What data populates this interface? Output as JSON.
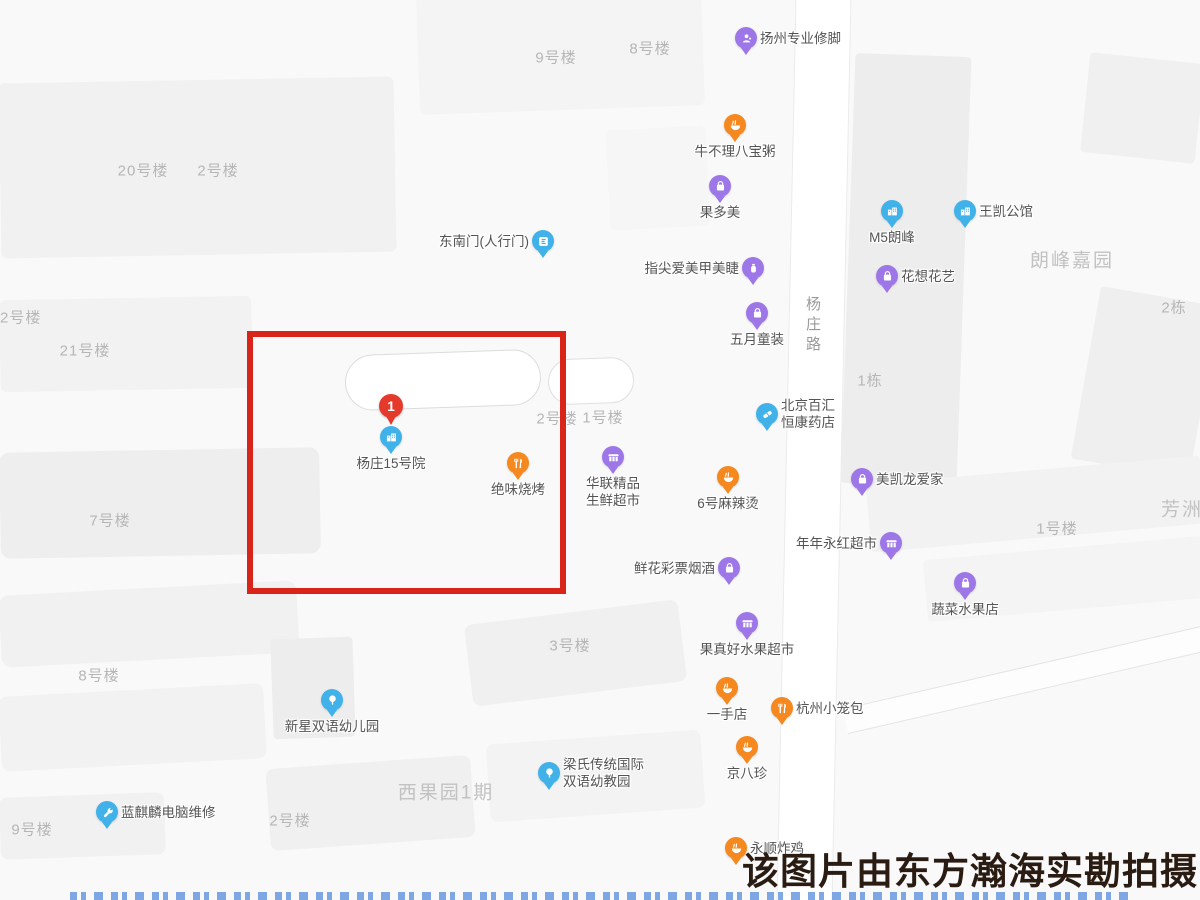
{
  "map": {
    "watermark": {
      "text": "该图片由东方瀚海实勘拍摄",
      "color": "#2a1c12"
    },
    "road_label": {
      "text": "杨庄路",
      "x": 802,
      "y": 296
    },
    "highlight_box": {
      "x": 247,
      "y": 331,
      "width": 319,
      "height": 263,
      "color": "#d9241a"
    },
    "colors": {
      "purple": "#9d77e8",
      "orange": "#f5881f",
      "blue": "#41b2e9",
      "red_pin": "#e5392c",
      "poi_text": "#545454",
      "building_text": "#b6b6b6",
      "area_text": "#c2c2c2"
    },
    "building_labels": [
      {
        "text": "9号楼",
        "x": 556,
        "y": 57
      },
      {
        "text": "8号楼",
        "x": 650,
        "y": 48
      },
      {
        "text": "20号楼",
        "x": 143,
        "y": 170
      },
      {
        "text": "2号楼",
        "x": 218,
        "y": 170
      },
      {
        "text": "22号楼",
        "x": 16,
        "y": 317
      },
      {
        "text": "21号楼",
        "x": 85,
        "y": 350
      },
      {
        "text": "2号楼",
        "x": 557,
        "y": 418
      },
      {
        "text": "1号楼",
        "x": 603,
        "y": 417
      },
      {
        "text": "7号楼",
        "x": 110,
        "y": 520
      },
      {
        "text": "1号楼",
        "x": 1057,
        "y": 528
      },
      {
        "text": "8号楼",
        "x": 99,
        "y": 675
      },
      {
        "text": "3号楼",
        "x": 570,
        "y": 645
      },
      {
        "text": "9号楼",
        "x": 32,
        "y": 829
      },
      {
        "text": "2号楼",
        "x": 290,
        "y": 820
      },
      {
        "text": "1栋",
        "x": 870,
        "y": 380
      },
      {
        "text": "2栋",
        "x": 1174,
        "y": 307
      }
    ],
    "area_labels": [
      {
        "text": "朗峰嘉园",
        "x": 1072,
        "y": 259
      },
      {
        "text": "西果园1期",
        "x": 446,
        "y": 791
      },
      {
        "text": "芳洲",
        "x": 1182,
        "y": 508
      }
    ],
    "pois": [
      {
        "id": "yangzhou-foot-massage",
        "label": "扬州专业修脚",
        "color": "purple",
        "icon": "massage",
        "x": 746,
        "y": 54,
        "pos": "right"
      },
      {
        "id": "niubuli-porridge",
        "label": "牛不理八宝粥",
        "color": "orange",
        "icon": "bowl",
        "x": 735,
        "y": 141,
        "pos": "below"
      },
      {
        "id": "guoduomei",
        "label": "果多美",
        "color": "purple",
        "icon": "bag",
        "x": 720,
        "y": 202,
        "pos": "below"
      },
      {
        "id": "southeast-gate",
        "label": "东南门(人行门)",
        "color": "blue",
        "icon": "gate",
        "x": 543,
        "y": 257,
        "pos": "left"
      },
      {
        "id": "nail-beauty",
        "label": "指尖爱美甲美睫",
        "color": "purple",
        "icon": "nail",
        "x": 753,
        "y": 284,
        "pos": "left"
      },
      {
        "id": "may-kids-clothing",
        "label": "五月童装",
        "color": "purple",
        "icon": "bag",
        "x": 757,
        "y": 329,
        "pos": "below"
      },
      {
        "id": "m5-langfeng",
        "label": "M5朗峰",
        "color": "blue",
        "icon": "building",
        "x": 892,
        "y": 227,
        "pos": "below"
      },
      {
        "id": "wangkai-mansion",
        "label": "王凯公馆",
        "color": "blue",
        "icon": "building",
        "x": 965,
        "y": 227,
        "pos": "right"
      },
      {
        "id": "huaxiang-florist",
        "label": "花想花艺",
        "color": "purple",
        "icon": "bag",
        "x": 887,
        "y": 292,
        "pos": "right"
      },
      {
        "id": "beijing-baihui-pharmacy",
        "label": "北京百汇|恒康药店",
        "color": "blue",
        "icon": "capsule",
        "x": 767,
        "y": 430,
        "pos": "right"
      },
      {
        "id": "yangzhuang-15-yard",
        "label": "杨庄15号院",
        "color": "blue",
        "icon": "building",
        "x": 391,
        "y": 453,
        "pos": "below",
        "badge": "1"
      },
      {
        "id": "juewei-bbq",
        "label": "绝味烧烤",
        "color": "orange",
        "icon": "forkknife",
        "x": 518,
        "y": 479,
        "pos": "below"
      },
      {
        "id": "hualian-supermarket",
        "label": "华联精品|生鲜超市",
        "color": "purple",
        "icon": "market",
        "x": 613,
        "y": 473,
        "pos": "below"
      },
      {
        "id": "no6-malatang",
        "label": "6号麻辣烫",
        "color": "orange",
        "icon": "bowl",
        "x": 728,
        "y": 493,
        "pos": "below"
      },
      {
        "id": "macalline-home",
        "label": "美凯龙爱家",
        "color": "purple",
        "icon": "bag",
        "x": 862,
        "y": 495,
        "pos": "right"
      },
      {
        "id": "niannian-yonghong",
        "label": "年年永红超市",
        "color": "purple",
        "icon": "market",
        "x": 891,
        "y": 559,
        "pos": "left"
      },
      {
        "id": "flower-lottery-tobacco",
        "label": "鲜花彩票烟酒",
        "color": "purple",
        "icon": "bag",
        "x": 729,
        "y": 584,
        "pos": "left"
      },
      {
        "id": "vegetable-fruit-store",
        "label": "蔬菜水果店",
        "color": "purple",
        "icon": "bag",
        "x": 965,
        "y": 599,
        "pos": "below"
      },
      {
        "id": "guozhenhao-fruit",
        "label": "果真好水果超市",
        "color": "purple",
        "icon": "market",
        "x": 747,
        "y": 639,
        "pos": "below"
      },
      {
        "id": "yishou-store",
        "label": "一手店",
        "color": "orange",
        "icon": "bowl",
        "x": 727,
        "y": 704,
        "pos": "below"
      },
      {
        "id": "xinxing-kindergarten",
        "label": "新星双语幼儿园",
        "color": "blue",
        "icon": "tree",
        "x": 332,
        "y": 716,
        "pos": "below"
      },
      {
        "id": "hangzhou-xiaolongbao",
        "label": "杭州小笼包",
        "color": "orange",
        "icon": "forkknife",
        "x": 782,
        "y": 724,
        "pos": "right"
      },
      {
        "id": "jingbazhen",
        "label": "京八珍",
        "color": "orange",
        "icon": "bowl",
        "x": 747,
        "y": 763,
        "pos": "below"
      },
      {
        "id": "liangshi-kindergarten",
        "label": "梁氏传统国际|双语幼教园",
        "color": "blue",
        "icon": "tree",
        "x": 549,
        "y": 789,
        "pos": "right"
      },
      {
        "id": "lanqilin-pc-repair",
        "label": "蓝麒麟电脑维修",
        "color": "blue",
        "icon": "wrench",
        "x": 107,
        "y": 828,
        "pos": "right"
      },
      {
        "id": "yongshun-fried-chicken",
        "label": "永顺炸鸡",
        "color": "orange",
        "icon": "bowl",
        "x": 736,
        "y": 864,
        "pos": "right"
      }
    ]
  }
}
